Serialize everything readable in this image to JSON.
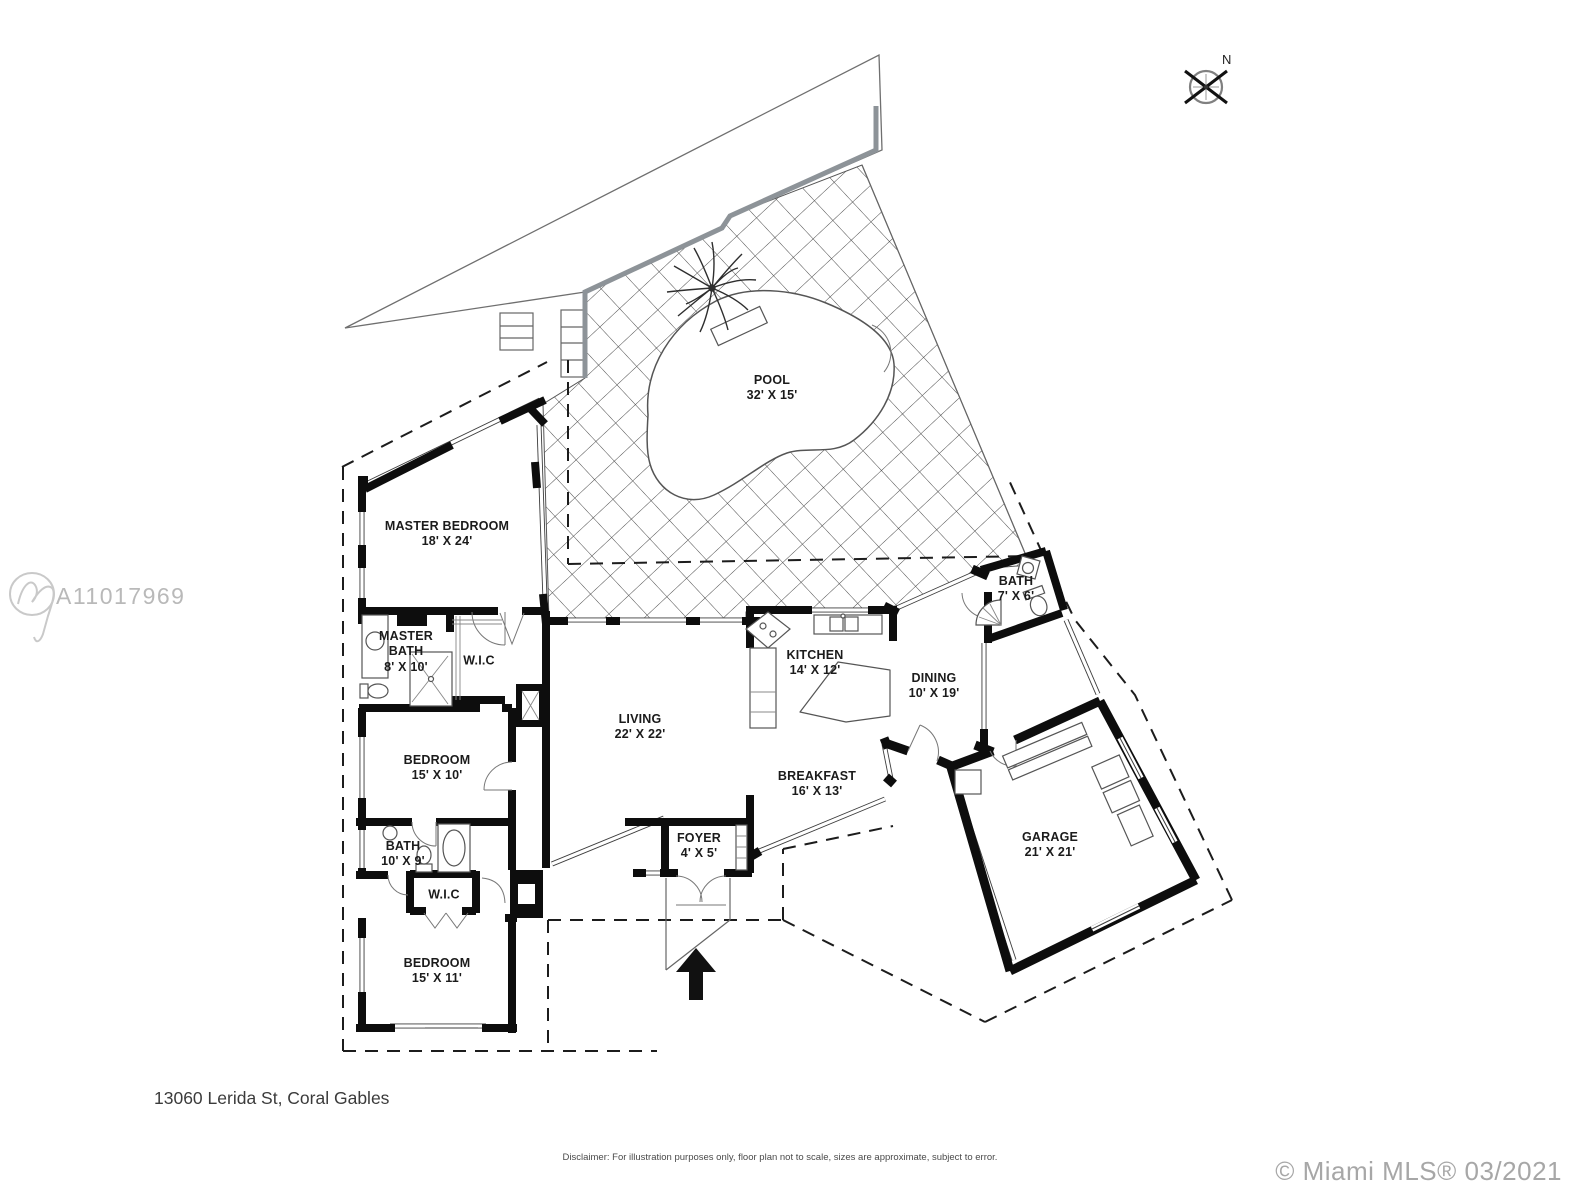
{
  "page": {
    "background": "#ffffff",
    "watermark_id": "A11017969",
    "compass_label": "N",
    "address": "13060 Lerida St, Coral Gables",
    "disclaimer": "Disclaimer: For illustration purposes only, floor plan not to scale, sizes are approximate, subject to error.",
    "copyright": "© Miami MLS® 03/2021"
  },
  "colors": {
    "wall": "#0d0d0d",
    "hatch_line": "#4a4a4a",
    "seawall": "#8d9398",
    "watermark": "#b9b9b9",
    "footer_gray": "#a7a7a7",
    "label_text": "#1b1b1b"
  },
  "rooms": {
    "pool": {
      "name": "POOL",
      "dims": "32' X 15'"
    },
    "master_bedroom": {
      "name": "MASTER BEDROOM",
      "dims": "18' X 24'"
    },
    "master_bath": {
      "name": "MASTER BATH",
      "dims": "8' X 10'"
    },
    "wic_master": {
      "name": "W.I.C",
      "dims": ""
    },
    "bedroom_mid": {
      "name": "BEDROOM",
      "dims": "15' X 10'"
    },
    "bath_hall": {
      "name": "BATH",
      "dims": "10' X 9'"
    },
    "wic_hall": {
      "name": "W.I.C",
      "dims": ""
    },
    "bedroom_front": {
      "name": "BEDROOM",
      "dims": "15' X 11'"
    },
    "living": {
      "name": "LIVING",
      "dims": "22' X 22'"
    },
    "foyer": {
      "name": "FOYER",
      "dims": "4' X 5'"
    },
    "kitchen": {
      "name": "KITCHEN",
      "dims": "14' X 12'"
    },
    "dining": {
      "name": "DINING",
      "dims": "10' X 19'"
    },
    "bath_guest": {
      "name": "BATH",
      "dims": "7' X 6'"
    },
    "breakfast": {
      "name": "BREAKFAST",
      "dims": "16' X 13'"
    },
    "garage": {
      "name": "GARAGE",
      "dims": "21' X 21'"
    }
  }
}
